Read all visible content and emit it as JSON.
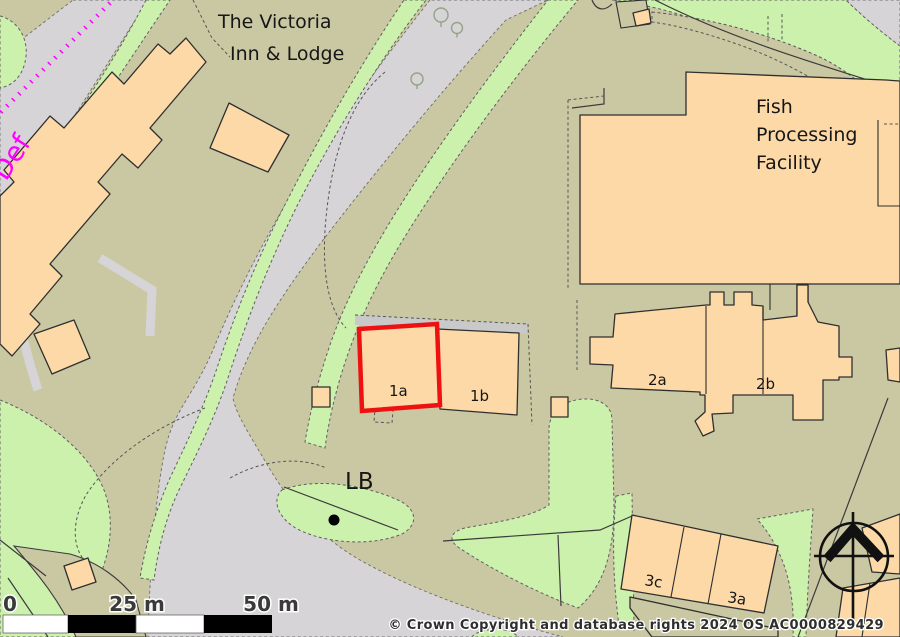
{
  "labels": {
    "victoria_line1": "The Victoria",
    "victoria_line2": "Inn & Lodge",
    "fish_line1": "Fish",
    "fish_line2": "Processing",
    "fish_line3": "Facility",
    "plot_1a": "1a",
    "plot_1b": "1b",
    "plot_2a": "2a",
    "plot_2b": "2b",
    "plot_3c": "3c",
    "plot_3a": "3a",
    "letter_box": "LB",
    "boundary_def": "Def"
  },
  "scale_bar": {
    "start_label": "0",
    "mid_label": "25 m",
    "end_label": "50 m",
    "total_length_m": 50
  },
  "attribution": "© Crown Copyright and database rights 2024 OS AC0000829429",
  "highlight": {
    "selected_plot": "1a",
    "outline_color": "#ee1111"
  },
  "colors": {
    "background_land": "#cac8a3",
    "road": "#d6d4d6",
    "greenspace": "#ccf1ad",
    "building": "#fcd9a7",
    "building_outline": "#2f2f2f",
    "boundary_def_line": "#ff00ff",
    "label_text": "#161616"
  },
  "icons": {
    "north_compass": "compass-north-icon",
    "tree": "tree-icon",
    "letter_box_marker": "point-marker-icon"
  }
}
